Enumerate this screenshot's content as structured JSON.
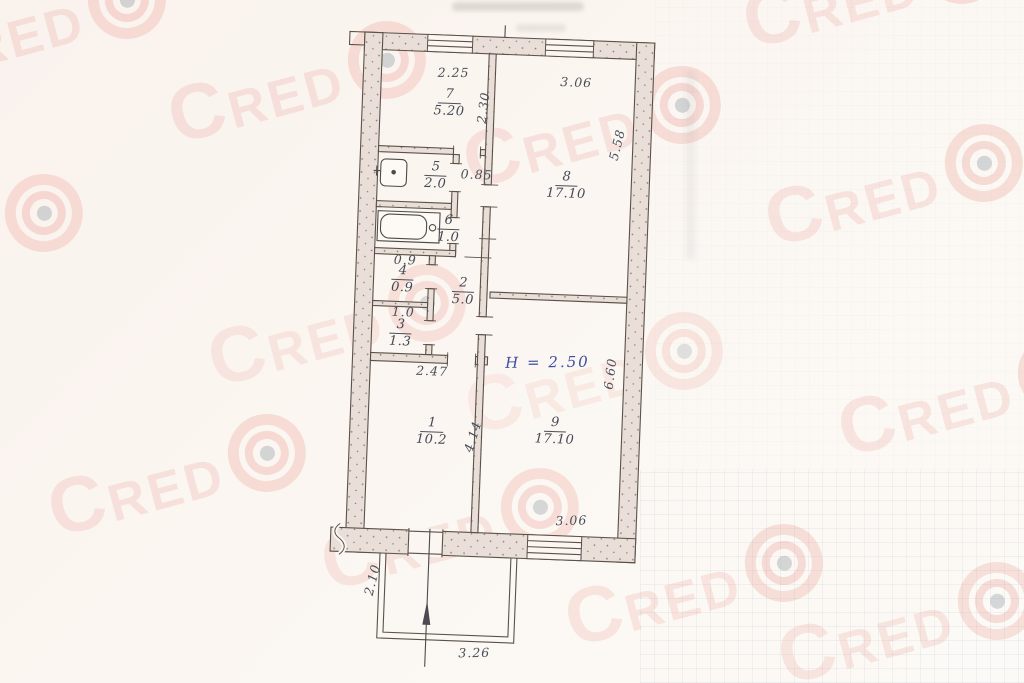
{
  "watermark": {
    "text": "CRED",
    "color": "#e06a5e"
  },
  "colors": {
    "paper": "#fbf5f0",
    "wall_fill": "#e9dfd8",
    "drawing_line": "#5a5148",
    "pencil_ink": "#4a4f5a",
    "blue_ink": "#3e4da0"
  },
  "plan": {
    "ceiling_height": "H = 2.50",
    "rooms": {
      "r1": {
        "number": "1",
        "area": "10.2"
      },
      "r2": {
        "number": "2",
        "area": "5.0"
      },
      "r3": {
        "number": "3",
        "area": "1.3"
      },
      "r4": {
        "number": "4",
        "area": "0.9"
      },
      "r5": {
        "number": "5",
        "area": "2.0"
      },
      "r6": {
        "number": "6",
        "area": "1.0"
      },
      "r7": {
        "number": "7",
        "area": "5.20"
      },
      "r8": {
        "number": "8",
        "area": "17.10"
      },
      "r9": {
        "number": "9",
        "area": "17.10"
      }
    },
    "dims": {
      "room7_width": "2.25",
      "room7_depth": "2.30",
      "room8_width": "3.06",
      "room8_depth": "5.58",
      "passage_width": "0.85",
      "room4_width": "0.9",
      "room3_width": "1.0",
      "room1_width": "2.47",
      "room1_depth": "4.14",
      "room9_depth": "6.60",
      "room9_window_width": "3.06",
      "balcony_depth": "2.10",
      "balcony_width": "3.26"
    }
  }
}
